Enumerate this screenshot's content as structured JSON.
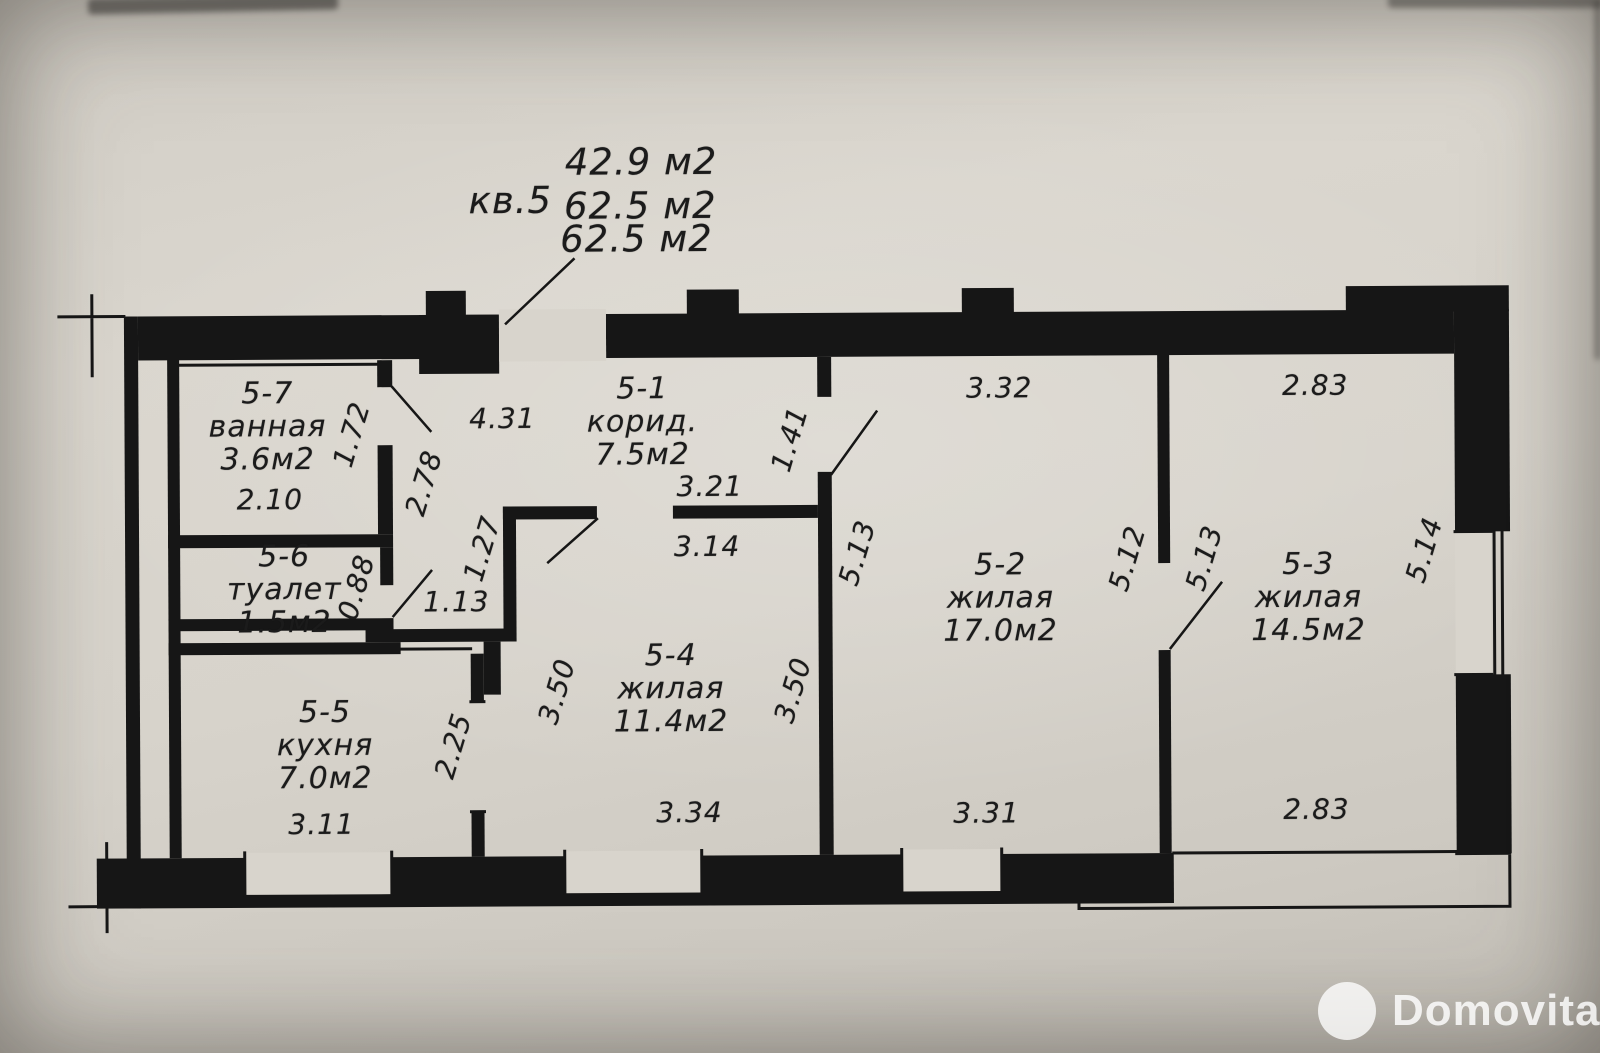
{
  "header": {
    "apartment": "кв.5",
    "area_line1": "42.9 м2",
    "area_line2": "62.5 м2",
    "area_line3": "62.5 м2"
  },
  "rooms": [
    {
      "id": "5-7",
      "name": "ванная",
      "area": "3.6м2"
    },
    {
      "id": "5-6",
      "name": "туалет",
      "area": "1.5м2"
    },
    {
      "id": "5-5",
      "name": "кухня",
      "area": "7.0м2"
    },
    {
      "id": "5-1",
      "name": "корид.",
      "area": "7.5м2"
    },
    {
      "id": "5-4",
      "name": "жилая",
      "area": "11.4м2"
    },
    {
      "id": "5-2",
      "name": "жилая",
      "area": "17.0м2"
    },
    {
      "id": "5-3",
      "name": "жилая",
      "area": "14.5м2"
    }
  ],
  "dimensions": [
    "2.10",
    "1.72",
    "2.78",
    "0.88",
    "1.13",
    "1.27",
    "2.25",
    "3.11",
    "4.31",
    "3.21",
    "3.14",
    "1.41",
    "3.50",
    "3.50",
    "3.34",
    "3.32",
    "5.13",
    "5.12",
    "5.13",
    "2.83",
    "5.14",
    "3.31",
    "2.83"
  ],
  "ink_color": "#161616",
  "paper_color": "#d8d4cc",
  "watermark": {
    "text": "Domovita"
  }
}
